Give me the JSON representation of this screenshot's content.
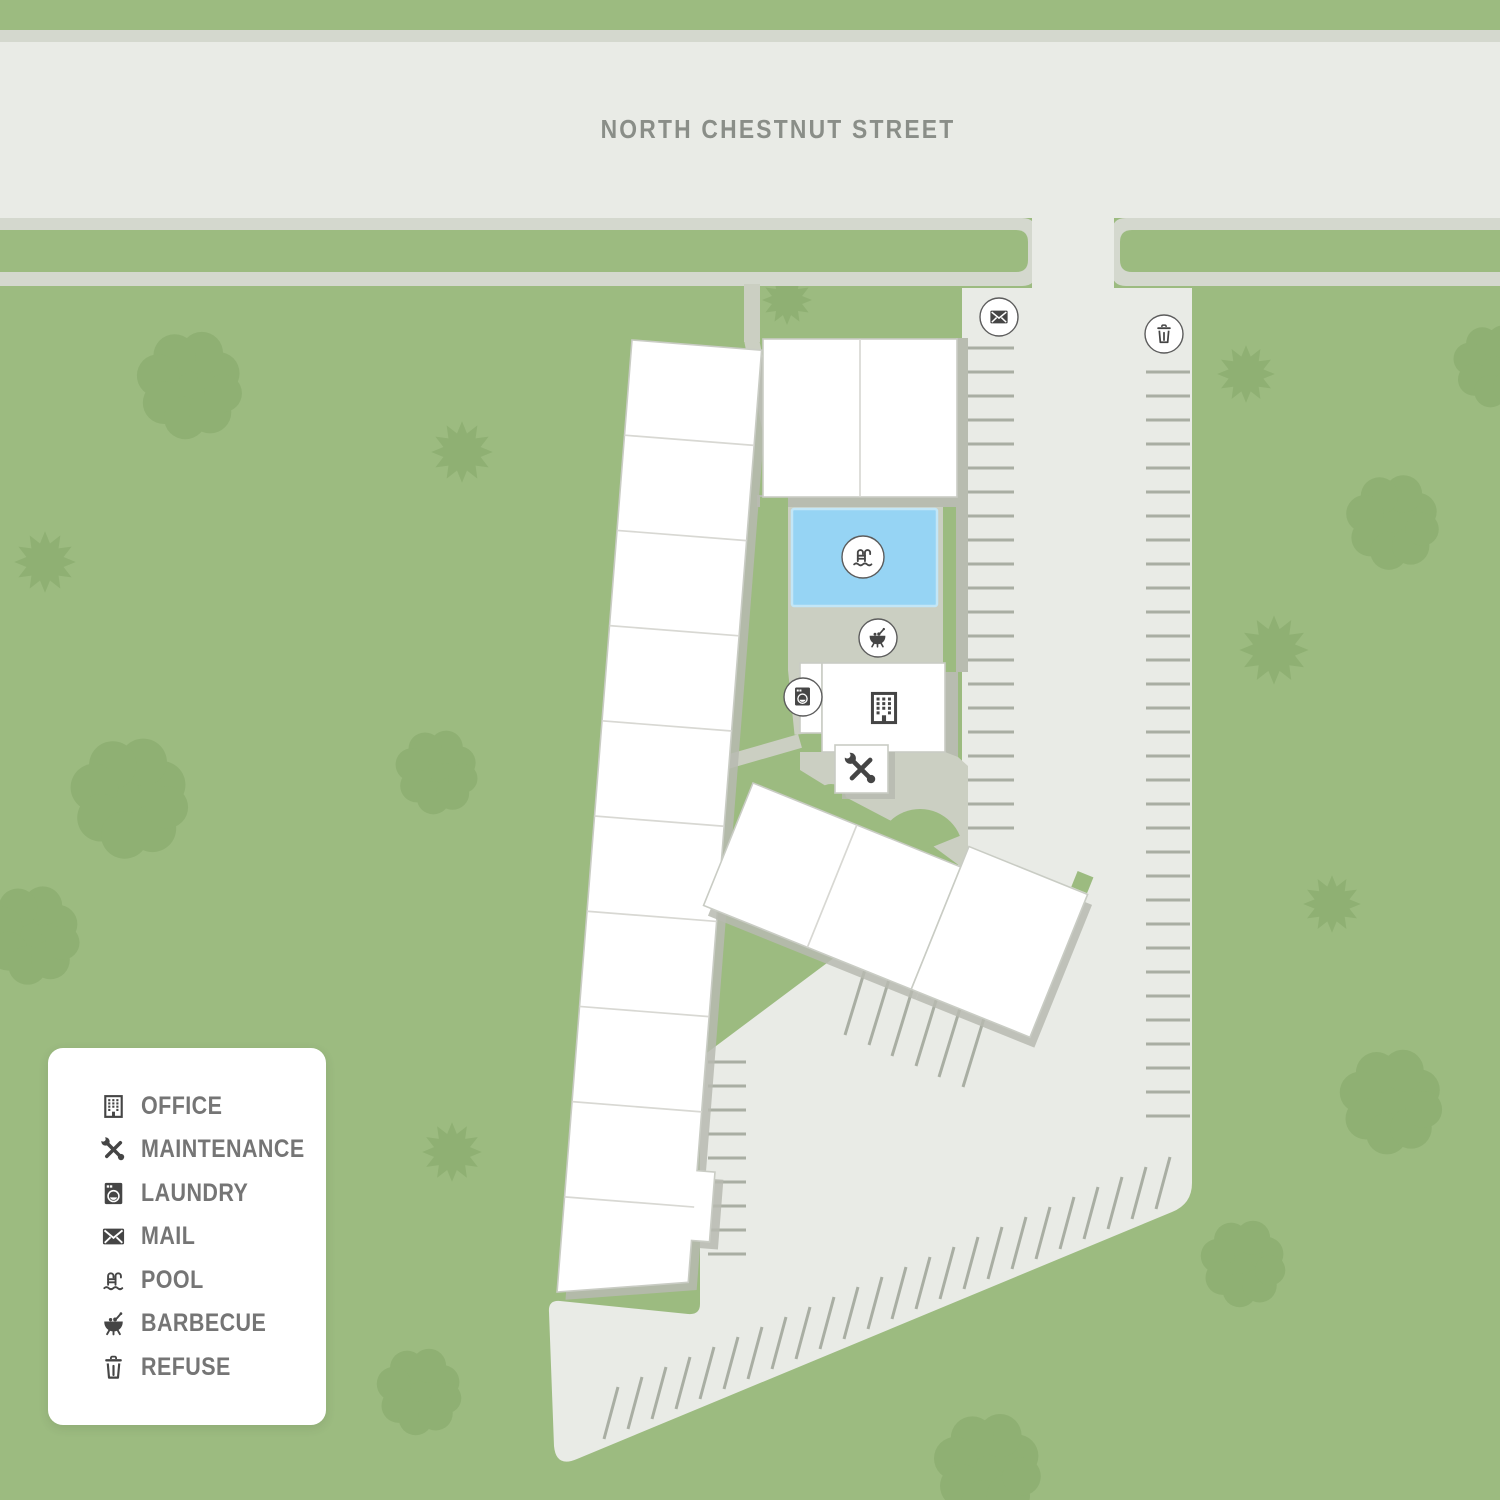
{
  "street": {
    "label": "NORTH CHESTNUT STREET"
  },
  "legend": {
    "items": [
      {
        "icon": "office-icon",
        "label": "OFFICE"
      },
      {
        "icon": "maintenance-icon",
        "label": "MAINTENANCE"
      },
      {
        "icon": "laundry-icon",
        "label": "LAUNDRY"
      },
      {
        "icon": "mail-icon",
        "label": "MAIL"
      },
      {
        "icon": "pool-icon",
        "label": "POOL"
      },
      {
        "icon": "barbecue-icon",
        "label": "BARBECUE"
      },
      {
        "icon": "refuse-icon",
        "label": "REFUSE"
      }
    ]
  },
  "map": {
    "markers": [
      {
        "icon": "mail-icon",
        "label": "MAIL"
      },
      {
        "icon": "refuse-icon",
        "label": "REFUSE"
      },
      {
        "icon": "pool-icon",
        "label": "POOL"
      },
      {
        "icon": "barbecue-icon",
        "label": "BARBECUE"
      },
      {
        "icon": "laundry-icon",
        "label": "LAUNDRY"
      },
      {
        "icon": "office-icon",
        "label": "OFFICE"
      },
      {
        "icon": "maintenance-icon",
        "label": "MAINTENANCE"
      }
    ]
  },
  "colors": {
    "grass": "#9cbb80",
    "tree": "#8fb073",
    "street": "#e9ebe6",
    "sidewalk": "#d4d8ce",
    "walkway": "#cbcfc2",
    "walkway_dark": "#b8bcb0",
    "stripe": "#a9aea3",
    "pool": "#96d4f4",
    "pool_border": "#c2e6f7",
    "building": "#ffffff",
    "building_border": "#c9ccc4",
    "shadow": "#b7bab0",
    "icon": "#454545",
    "label_text": "#757575",
    "street_text": "#8a8e88"
  }
}
